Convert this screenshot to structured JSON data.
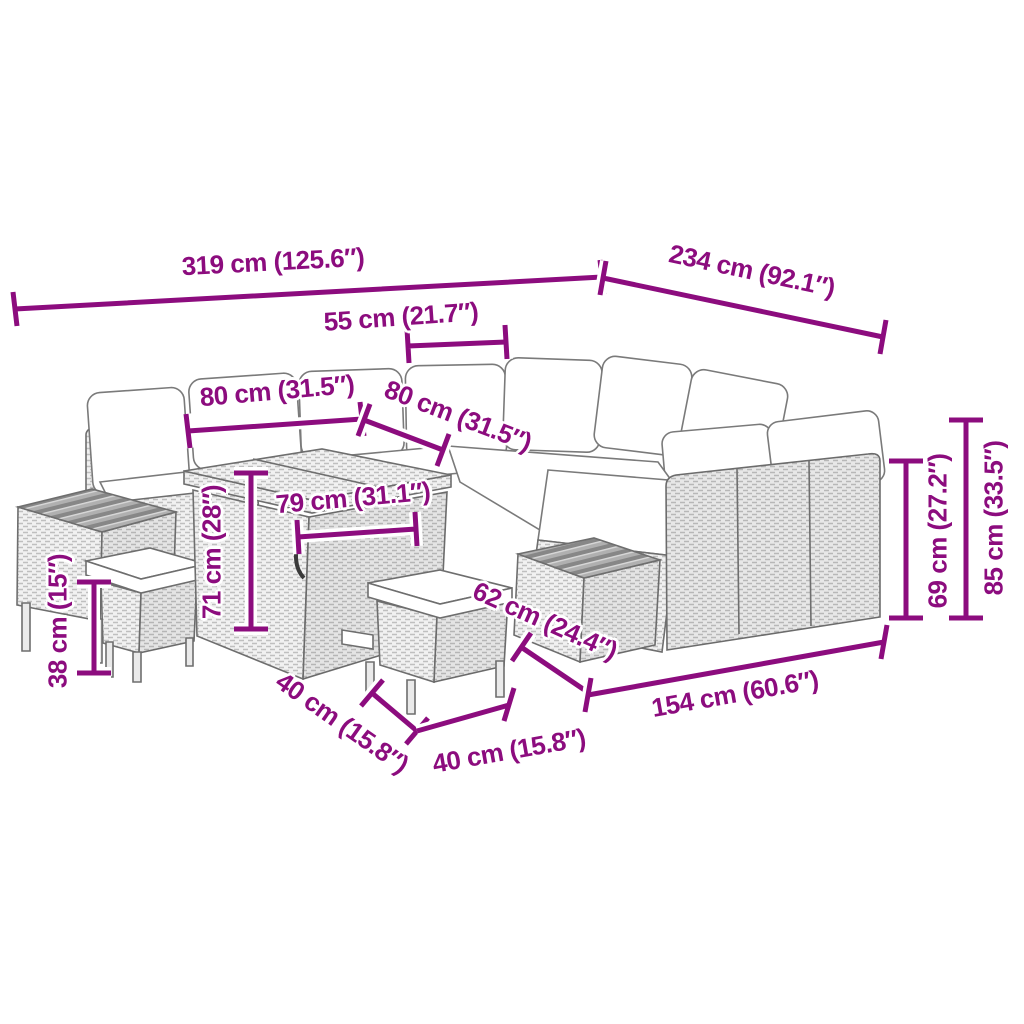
{
  "accent_color": "#8c0c7e",
  "figure": {
    "type": "product-dimension-diagram",
    "subject": "rattan garden lounge set with white cushions, storage cube table, wood-top side tables and stools"
  },
  "dimensions": {
    "overall_width": {
      "label": "319 cm (125.6″)"
    },
    "overall_depth": {
      "label": "234 cm (92.1″)"
    },
    "seat_width": {
      "label": "55 cm (21.7″)"
    },
    "section_left": {
      "label": "80 cm (31.5″)"
    },
    "section_right": {
      "label": "80 cm (31.5″)"
    },
    "table_width": {
      "label": "79 cm (31.1″)"
    },
    "table_height": {
      "label": "71 cm (28″)"
    },
    "stool_height": {
      "label": "38 cm (15″)"
    },
    "stool_width": {
      "label": "40 cm (15.8″)"
    },
    "stool_depth": {
      "label": "40 cm (15.8″)"
    },
    "side_table_width": {
      "label": "62 cm (24.4″)"
    },
    "sofa_length": {
      "label": "154 cm (60.6″)"
    },
    "back_height": {
      "label": "69 cm (27.2″)"
    },
    "overall_height": {
      "label": "85 cm (33.5″)"
    }
  }
}
